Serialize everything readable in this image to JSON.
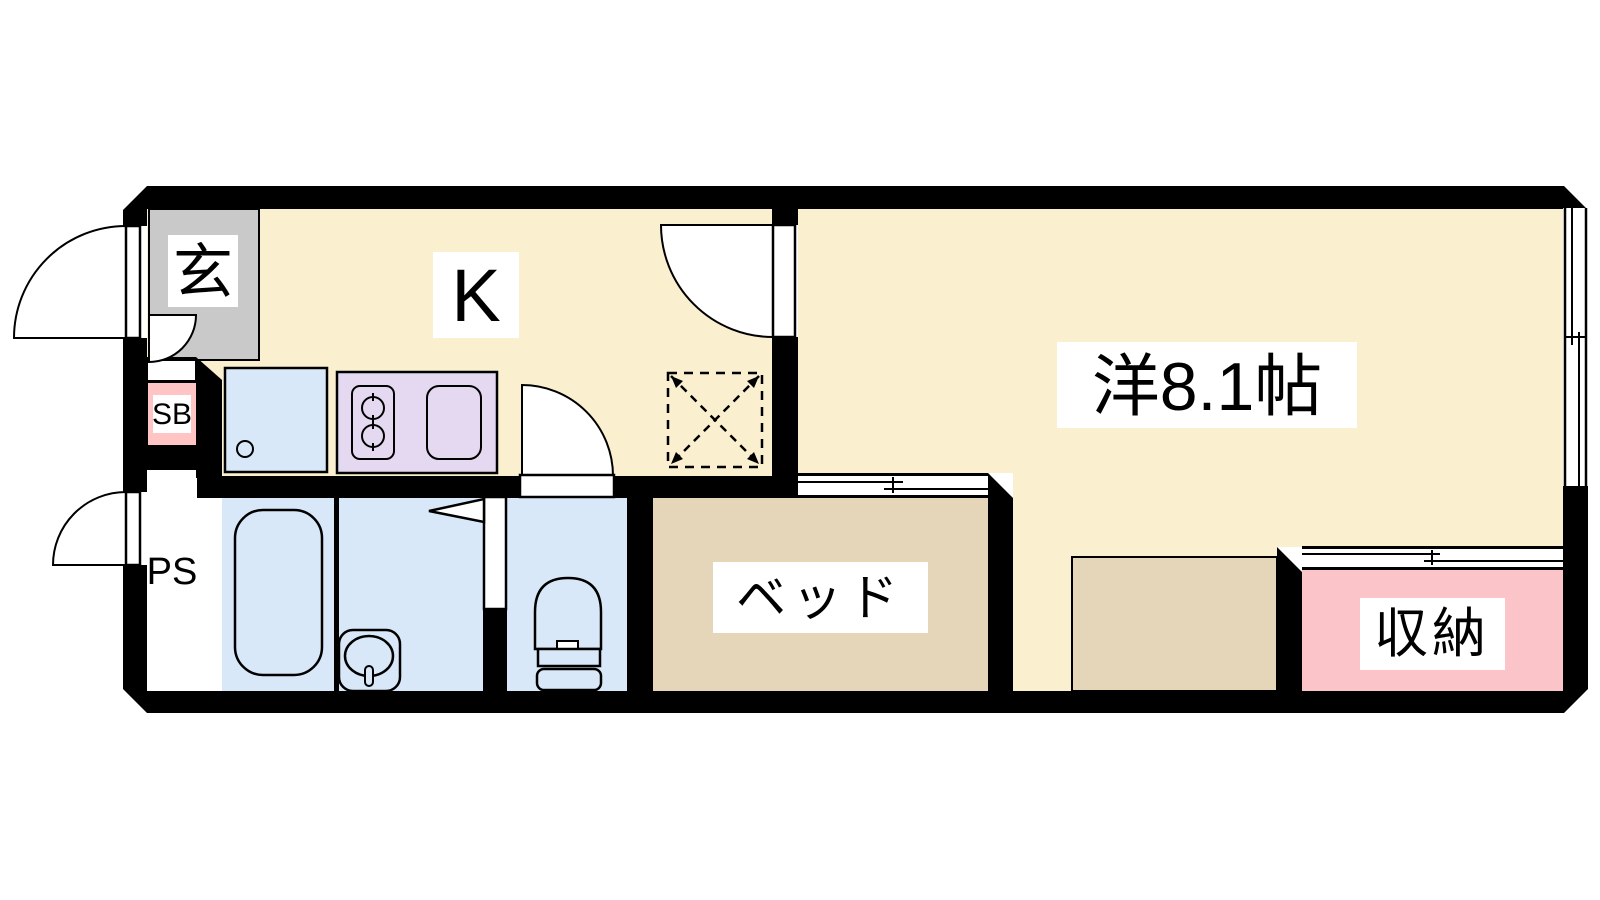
{
  "plan_title": "1K floor plan",
  "colors": {
    "floor_cream": "#FAEFCF",
    "genkan_gray": "#C9C9C9",
    "wet_area_blue": "#D8E8F8",
    "stove_lavender": "#E4D9F0",
    "bed_tan": "#E5D5B9",
    "closet_pink": "#FBC4C8",
    "shoebox_pink": "#FFC4C4",
    "wall_black": "#000000",
    "label_bg": "#FFFFFF"
  },
  "rooms": {
    "genkan": {
      "label": "玄"
    },
    "kitchen": {
      "label": "K"
    },
    "western_room": {
      "label": "洋8.1帖"
    },
    "bed": {
      "label": "ベッド"
    },
    "closet": {
      "label": "収納"
    },
    "shoe_box": {
      "label": "SB"
    },
    "pipe_space": {
      "label": "PS"
    }
  }
}
